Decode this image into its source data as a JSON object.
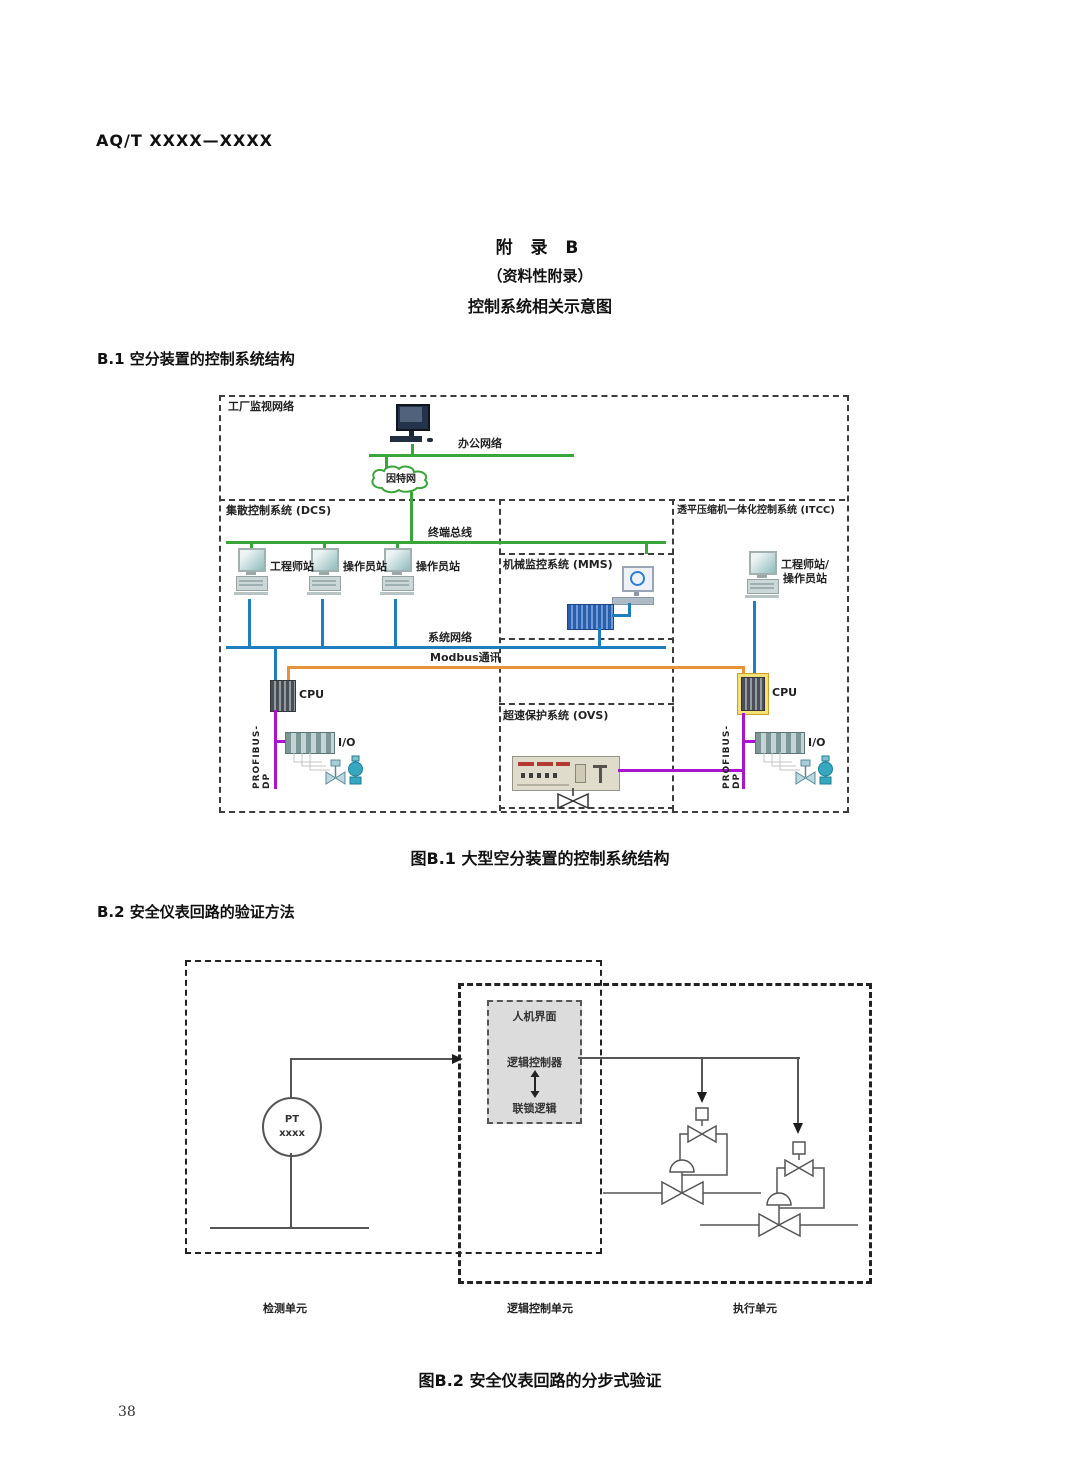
{
  "colors": {
    "green": "#3aa53a",
    "blue": "#1f7fbe",
    "orange": "#e8933a",
    "purple": "#a915cf"
  },
  "header": {
    "doc_code": "AQ/T XXXX—XXXX",
    "page_number": "38"
  },
  "appendix": {
    "title": "附  录  B",
    "subtitle": "（资料性附录）",
    "caption": "控制系统相关示意图"
  },
  "section_b1": {
    "heading": "B.1  空分装置的控制系统结构",
    "figure_caption": "图B.1  大型空分装置的控制系统结构",
    "diagram": {
      "plant_network": "工厂监视网络",
      "office_network": "办公网络",
      "internet": "因特网",
      "dcs": "集散控制系统 (DCS)",
      "itcc": "透平压缩机一体化控制系统 (ITCC)",
      "terminal_bus": "终端总线",
      "mms": "机械监控系统 (MMS)",
      "stations": [
        "工程师站",
        "操作员站",
        "操作员站"
      ],
      "itcc_station_line1": "工程师站/",
      "itcc_station_line2": "操作员站",
      "system_network": "系统网络",
      "modbus": "Modbus通讯",
      "cpu": "CPU",
      "io": "I/O",
      "profibus": "PROFIBUS-DP",
      "ovs": "超速保护系统 (OVS)"
    }
  },
  "section_b2": {
    "heading": "B.2  安全仪表回路的验证方法",
    "figure_caption": "图B.2  安全仪表回路的分步式验证",
    "diagram": {
      "hmi": "人机界面",
      "logic_controller": "逻辑控制器",
      "interlock_logic": "联锁逻辑",
      "pt_tag": "PT",
      "pt_number": "xxxx",
      "detect_unit": "检测单元",
      "logic_unit": "逻辑控制单元",
      "exec_unit": "执行单元"
    }
  }
}
